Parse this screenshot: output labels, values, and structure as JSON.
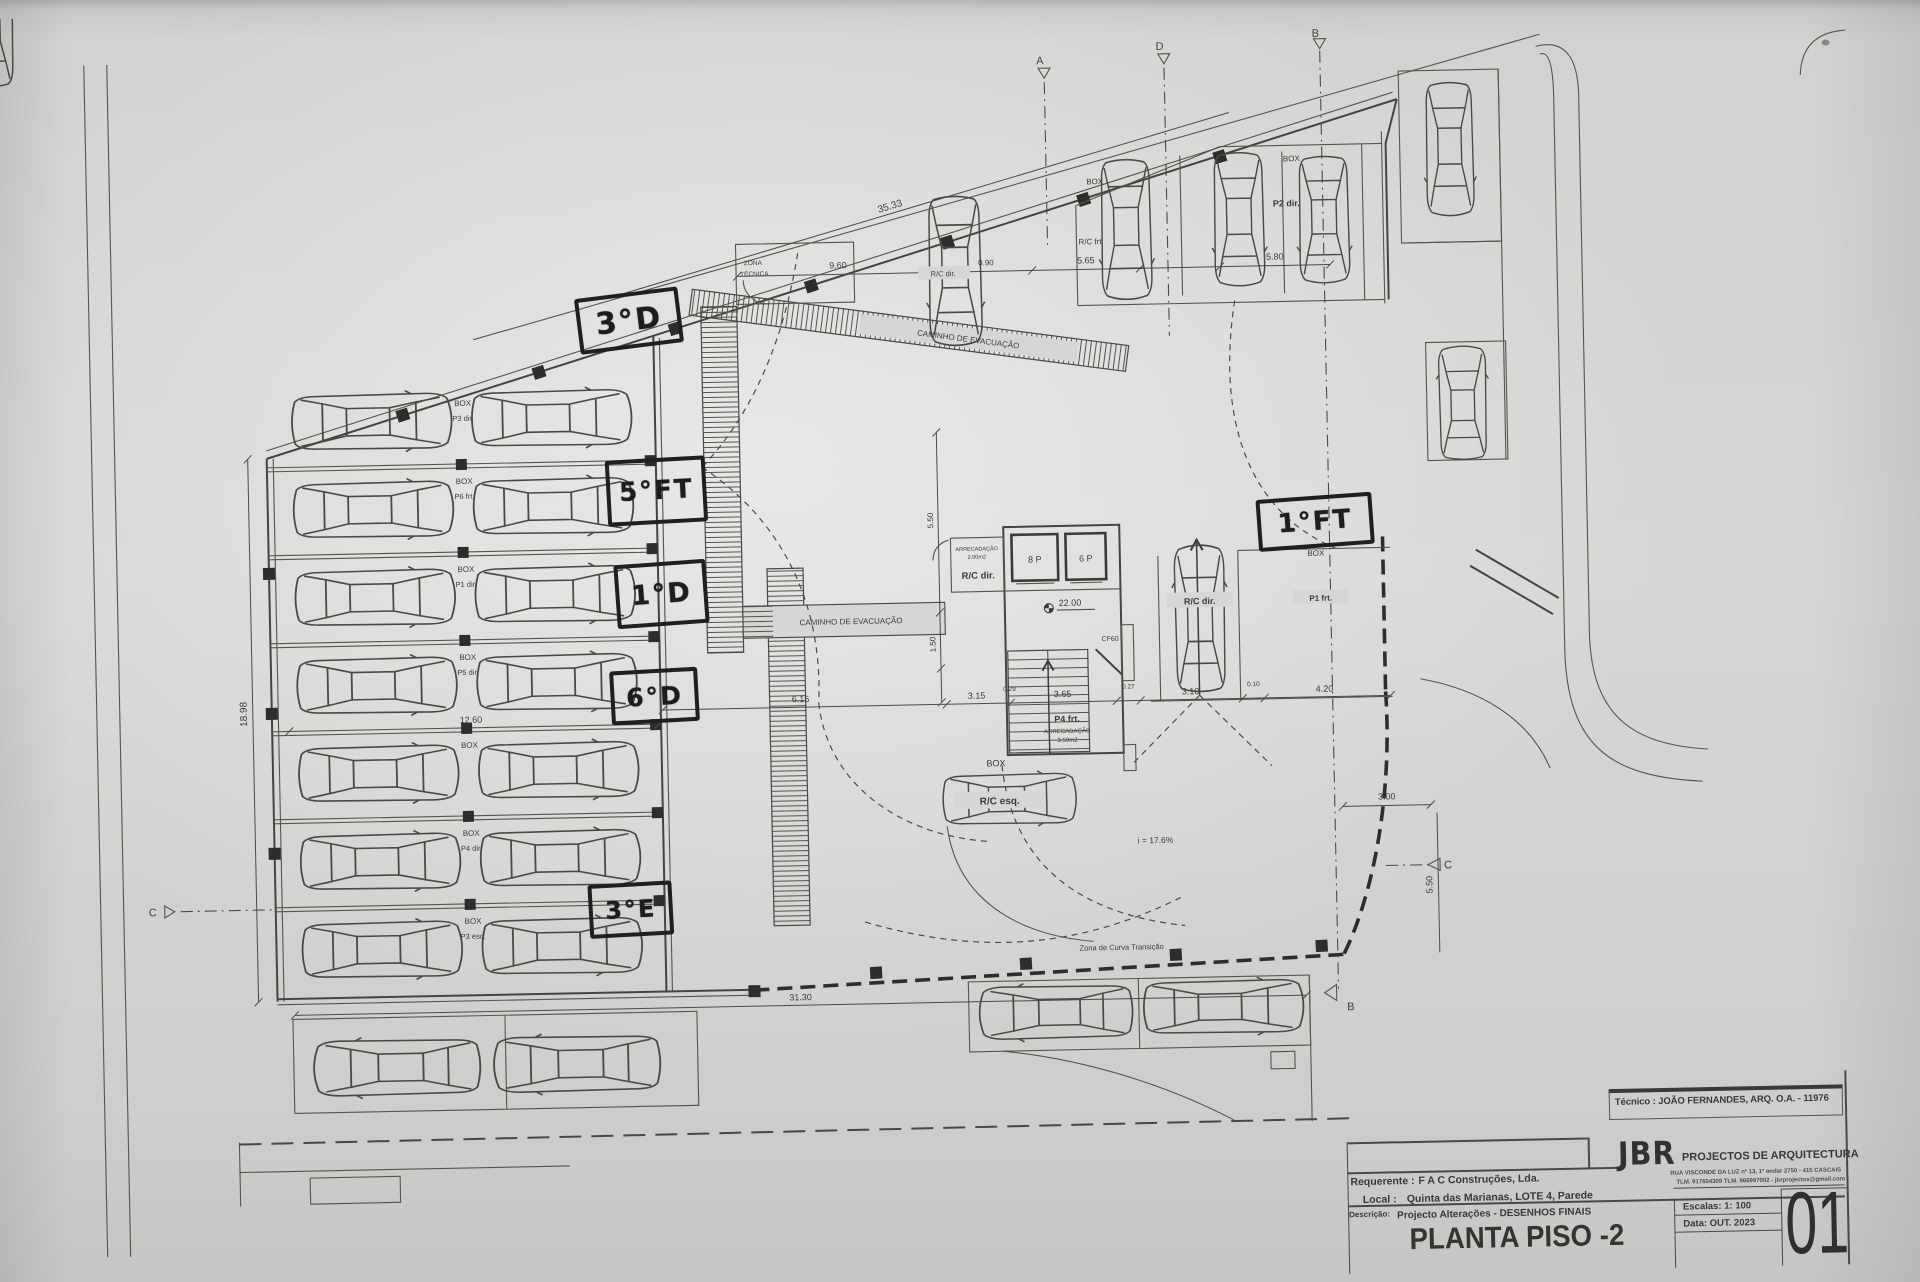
{
  "titleblock": {
    "tecnico": "Técnico : JOÃO FERNANDES, ARQ.  O.A. - 11976",
    "logo": "JBR",
    "firm": "PROJECTOS DE ARQUITECTURA",
    "address": "RUA VISCONDE DA LUZ nº 13, 1º andar  2750 - 415  CASCAIS",
    "contacts": "TLM. 917604309  TLM. 966997002  -  jbrprojectos@gmail.com",
    "requerente_label": "Requerente :",
    "requerente": "F A C  Construções, Lda.",
    "local_label": "Local :",
    "local": "Quinta das Marianas, LOTE 4, Parede",
    "descricao_label": "Descrição:",
    "descricao": "Projecto Alterações - DESENHOS FINAIS",
    "title": "PLANTA PISO -2",
    "escala": "Escalas:  1: 100",
    "data": "Data: OUT.  2023",
    "sheet": "01"
  },
  "annotations": {
    "a1": "3°D",
    "a2": "5°FT",
    "a3": "1°D",
    "a4": "6°D",
    "a5": "3°E",
    "a6": "1°FT"
  },
  "labels": {
    "box": "BOX",
    "zona1": "ZONA",
    "zona2": "TÉCNICA",
    "caminho": "CAMINHO DE EVACUAÇÃO",
    "arrec": "ARRECADAÇÃO",
    "arrec1m": "2.00m2",
    "arrec2m": "3.50m2",
    "rc_dir": "R/C dir.",
    "rc_esq": "R/C esq.",
    "rc_frt": "R/C frt",
    "p2dir": "P2 dir.",
    "p1frt": "P1 frt.",
    "p4frt": "P4 frt.",
    "lift8": "8 P",
    "lift6": "6 P",
    "nivel": "22.00",
    "cf60": "CF60",
    "slope": "i = 17.6%",
    "curva": "Zona de Curva Transição"
  },
  "stalls": [
    {
      "box": "BOX",
      "tag": "P3 dir."
    },
    {
      "box": "BOX",
      "tag": "P6 frt."
    },
    {
      "box": "BOX",
      "tag": "P1 dir."
    },
    {
      "box": "BOX",
      "tag": "P5 dir."
    },
    {
      "box": "BOX",
      "tag": ""
    },
    {
      "box": "BOX",
      "tag": "P4 dir."
    },
    {
      "box": "BOX",
      "tag": "P3 esq."
    }
  ],
  "dims": {
    "t3533": "35.33",
    "d960": "9.60",
    "d090": "0.90",
    "d565": "5.65",
    "d580": "5.80",
    "d1898": "18.98",
    "d1260": "12.60",
    "d615": "6.15",
    "d315": "3.15",
    "d029": "0.29",
    "d365": "3.65",
    "d027": "0.27",
    "d310": "3.10",
    "d010": "0.10",
    "d420": "4.20",
    "d3130": "31.30",
    "d300": "3.00",
    "d550": "5.50",
    "d150": "1.50"
  },
  "markers": {
    "a": "A",
    "d": "D",
    "b": "B",
    "c": "C",
    "b2": "B"
  }
}
